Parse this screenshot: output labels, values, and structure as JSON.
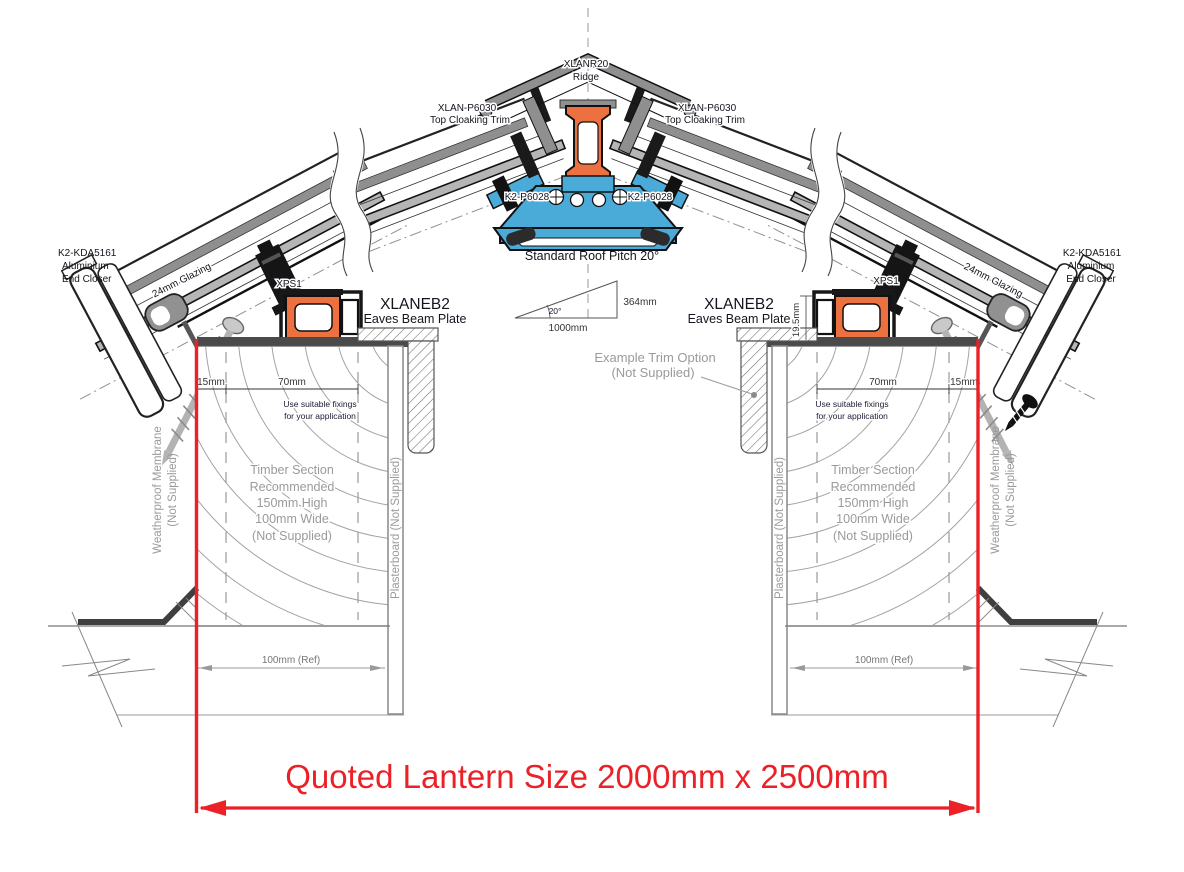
{
  "drawing": {
    "ridge": {
      "model": "XLANR20",
      "name": "Ridge"
    },
    "cloaking_trim": {
      "model": "XLAN-P6030",
      "name": "Top Cloaking Trim"
    },
    "ridge_fixing": {
      "model": "K2-P6028"
    },
    "pitch": {
      "note": "Standard Roof Pitch 20°",
      "angle": "20°",
      "run": "1000mm",
      "rise": "364mm"
    },
    "end_closer": {
      "model": "K2-KDA5161",
      "line2": "Aluminium",
      "line3": "End Closer"
    },
    "glazing": {
      "label": "24mm Glazing"
    },
    "gasket": {
      "label": "XPS1"
    },
    "eaves_beam": {
      "model": "XLANEB2",
      "name": "Eaves Beam Plate"
    },
    "trim_option": {
      "line1": "Example Trim Option",
      "line2": "(Not Supplied)"
    },
    "dims": {
      "d15": "15mm",
      "d70": "70mm",
      "d19_5": "19.5mm",
      "ref100": "100mm (Ref)"
    },
    "fixings_note": {
      "line1": "Use suitable fixings",
      "line2": "for your application"
    },
    "timber": {
      "lines": [
        "Timber Section",
        "Recommended",
        "150mm High",
        "100mm Wide",
        "(Not Supplied)"
      ]
    },
    "membrane": {
      "line1": "Weatherproof Membrane",
      "line2": "(Not Supplied)"
    },
    "plasterboard": {
      "label": "Plasterboard (Not Supplied)"
    },
    "quoted_size": "Quoted Lantern Size 2000mm x 2500mm",
    "colors": {
      "accent_orange": "#EC7040",
      "accent_blue": "#4AAAD8",
      "dimension_red": "#EC2027",
      "profile_gray": "#8F8F8F"
    }
  }
}
